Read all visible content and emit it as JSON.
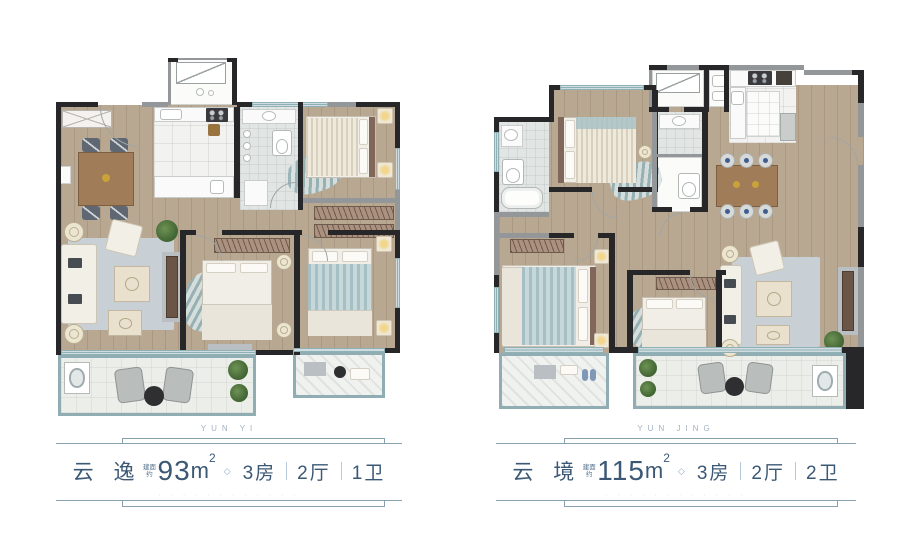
{
  "units": [
    {
      "id": "yunyi",
      "pinyin": "YUN YI",
      "name": "云 逸",
      "area_note": "建面约",
      "area_value": "93",
      "area_unit": "m",
      "area_sup": "2",
      "diamond": "◇",
      "specs": [
        "3房",
        "2厅",
        "1卫"
      ],
      "fine_print": "· · · · · ·    · · · · · ·"
    },
    {
      "id": "yunjing",
      "pinyin": "YUN JING",
      "name": "云 境",
      "area_note": "建面约",
      "area_value": "115",
      "area_unit": "m",
      "area_sup": "2",
      "diamond": "◇",
      "specs": [
        "3房",
        "2厅",
        "2卫"
      ],
      "fine_print": "· · · · · ·    · · · · · ·"
    }
  ],
  "colors": {
    "text_navy": "#3b5875",
    "pinyin_gray": "#a3b2c0",
    "deco_line": "#87a0ae",
    "wall_dark": "#27272a",
    "wall_gray": "#94979a",
    "window_teal": "#8fb0b5",
    "wood_floor": "#b9a891",
    "balcony_border": "#8fadb3"
  }
}
